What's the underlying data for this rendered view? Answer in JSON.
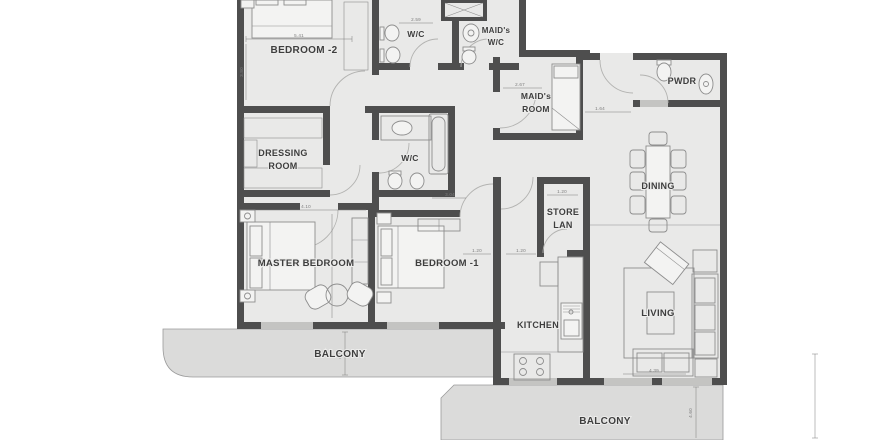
{
  "title": "apartment-floor-plan",
  "rooms": {
    "bedroom2": {
      "label": "BEDROOM -2"
    },
    "wc_top": {
      "label": "W/C"
    },
    "maids_wc": {
      "line1": "MAID's",
      "line2": "W/C"
    },
    "maids_room": {
      "line1": "MAID's",
      "line2": "ROOM"
    },
    "pwdr": {
      "label": "PWDR"
    },
    "dressing": {
      "line1": "DRESSING",
      "line2": "ROOM"
    },
    "wc_mid": {
      "label": "W/C"
    },
    "dining": {
      "label": "DINING"
    },
    "store": {
      "line1": "STORE",
      "line2": "LAN"
    },
    "master": {
      "label": "MASTER BEDROOM"
    },
    "bedroom1": {
      "label": "BEDROOM -1"
    },
    "kitchen": {
      "label": "KITCHEN"
    },
    "living": {
      "label": "LIVING"
    },
    "balcony_left": {
      "label": "BALCONY"
    },
    "balcony_bottom": {
      "label": "BALCONY"
    }
  },
  "dimensions": {
    "bedroom2_width": "5.41",
    "bedroom2_depth": "3.80",
    "wc_top_width": "2.59",
    "master_width": "4.10",
    "hall_width": "3.04",
    "maids_room_width": "2.67",
    "entry_width": "1.64",
    "store_width": "1.20",
    "hall_dim_a": "1.20",
    "hall_dim_b": "1.20",
    "living_width": "4.39",
    "balcony_left_depth": "4.15",
    "balcony_bottom_depth": "4.60"
  },
  "colors": {
    "bg": "#ffffff",
    "floor": "#e9e9e8",
    "balconyfloor": "#dbdbda",
    "wall": "#4e4e4e",
    "window": "#c4c4c2",
    "furniture": "#8d8d8d",
    "line": "#9a9a9a",
    "label": "#3e3e3e",
    "dim": "#7d7d7d"
  }
}
